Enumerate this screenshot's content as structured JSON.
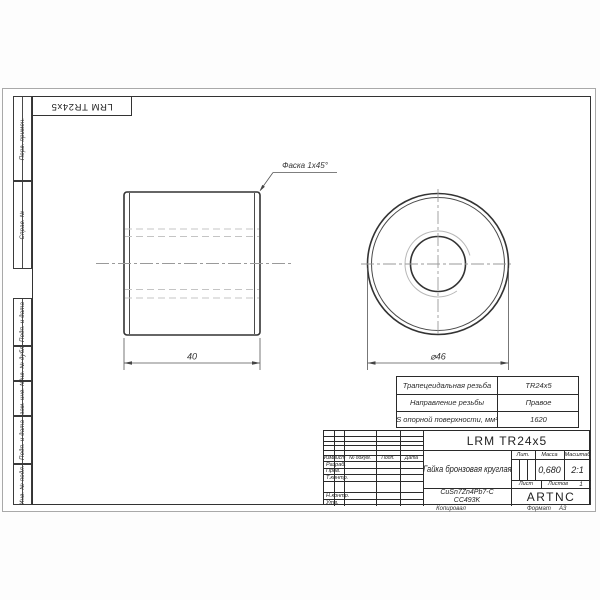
{
  "page": {
    "copied": "Копировал",
    "format_label": "Формат",
    "format_value": "А3"
  },
  "stamp_top": {
    "designation": "LRM TR24x5"
  },
  "margin": {
    "perv_primen": "Перв. примен.",
    "sprav_no": "Справ. №",
    "podp_data_top": "Подп. и дата",
    "inv_dubl": "Инв. № дубл.",
    "vzam_inv": "Взам. инв. №",
    "podp_data_bottom": "Подп. и дата",
    "inv_podl": "Инв. № подл."
  },
  "views": {
    "chamfer_note": "Фаска 1x45°",
    "length_dim": "40",
    "diameter_dim": "⌀46"
  },
  "spec_table": {
    "row1_label": "Трапецеидальная резьба",
    "row1_value": "TR24x5",
    "row2_label": "Направление резьбы",
    "row2_value": "Правое",
    "row3_label": "S опорной поверхности, мм²",
    "row3_value": "1620"
  },
  "title_block": {
    "designation": "LRM TR24x5",
    "name": "Гайка бронзовая круглая",
    "material_line1": "CuSn7Zn4Pb7-C",
    "material_line2": "CC493K",
    "company": "ARTNC",
    "col_izm": "Изм.",
    "col_list": "Лист",
    "col_dokum": "№ докум.",
    "col_podp": "Подп.",
    "col_data": "Дата",
    "row_razrab": "Разраб.",
    "row_prov": "Пров.",
    "row_tkontr": "Т.контр.",
    "row_nkontr": "Н.контр.",
    "row_utv": "Утв.",
    "lit_label": "Лит.",
    "mass_label": "Масса",
    "scale_label": "Масштаб",
    "mass_value": "0,680",
    "scale_value": "2:1",
    "list_label": "Лист",
    "listov_label": "Листов",
    "listov_value": "1"
  }
}
